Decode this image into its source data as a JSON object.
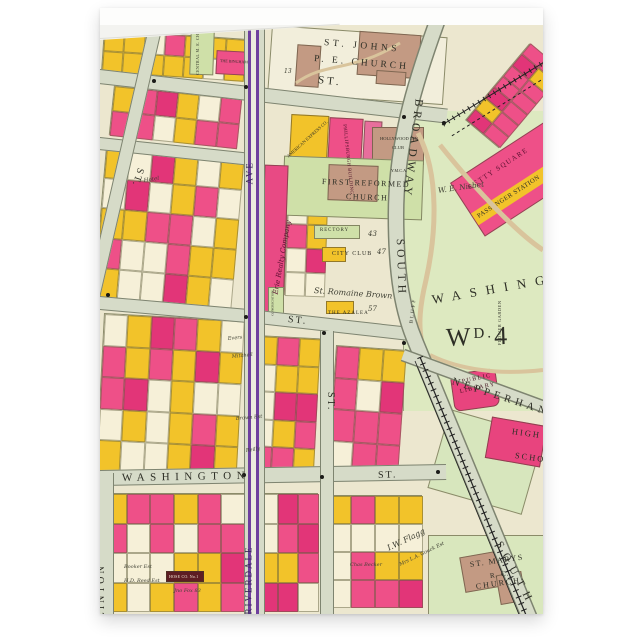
{
  "card": {
    "type_label": "folded greeting card"
  },
  "map": {
    "streets": {
      "st": "ST.",
      "washington": "WASHINGTON",
      "riverdale": "RIVERDALE",
      "ave": "AVE",
      "south": "SOUTH",
      "broadway": "BROADWAY",
      "nepperhan": "NEPPERHAN",
      "clinton": "CLINTON"
    },
    "landmarks": {
      "st_johns_1": "ST. JOHNS",
      "st_johns_2": "P. E. CHURCH",
      "central_me": "CENTRAL M. E. CHURCH",
      "bingham": "THE BINGHAM",
      "american_express": "AMERICAN EXPRESS CO.",
      "phillipsburgh": "PHILLIPSBURGH BUILDING",
      "hollywood_1": "HOLLYWOOD INN",
      "hollywood_2": "CLUB",
      "ymca": "Y.M.C.A.",
      "first_reformed_1": "FIRST REFORMED",
      "first_reformed_2": "CHURCH",
      "rectory": "RECTORY",
      "city_club": "CITY CLUB",
      "romaine": "St. Romaine Brown",
      "azalea": "THE AZALEA",
      "erie": "Erie Realty Company",
      "congregation": "CONGREGATION",
      "getty_1": "GETTY SQUARE",
      "getty_2": "PASSENGER STATION",
      "nisbet": "W. E. Nisbet",
      "park": "WASHINGTON",
      "flower_garden": "FLOWER GARDEN",
      "bluff": "BLUFF",
      "ward_w": "W",
      "ward_d": "D.",
      "ward_num": "4",
      "library_1": "PUBLIC",
      "library_2": "LIBRARY",
      "high": "HIGH",
      "school": "SCHOOL",
      "st_marys_1": "ST. MARYS",
      "st_marys_2": "R. C.",
      "st_marys_3": "CHURCH",
      "hose": "HOSE CO. No.1",
      "flagg": "I.W. Flagg",
      "gouck": "Mrs L.A. Gouck Est"
    },
    "parcels": {
      "evers": "Evers",
      "mitchell": "Mitchell",
      "brown_est": "Brown Est",
      "reilly": "Reilly",
      "hotel": "Hotel",
      "jno_fox": "Jno Fox 83",
      "booker": "Booker Est",
      "reed": "H.D. Reed Est",
      "becker": "Chas Becker",
      "lot13": "13",
      "rectory_num": "43",
      "cityclub_num": "47",
      "azalea_num": "57"
    },
    "palette": {
      "page_bg": "#ffffff",
      "card_bg": "#fdfdfc",
      "map_paper": "#ece7cf",
      "block_cream": "#f6f0d8",
      "street_fill": "#d6dbc8",
      "street_edge": "#7e8470",
      "parcel_pink": "#ee5088",
      "parcel_pink_deep": "#e23578",
      "parcel_yellow": "#f2c32a",
      "building_brown": "#c39a83",
      "inst_green": "#cfe0a8",
      "park_green": "#dde9c0",
      "trolley_purple": "#6e3f9e",
      "rail_black": "#222222",
      "path_tan": "#d9c49c",
      "label_ink": "#2e2f26"
    }
  }
}
